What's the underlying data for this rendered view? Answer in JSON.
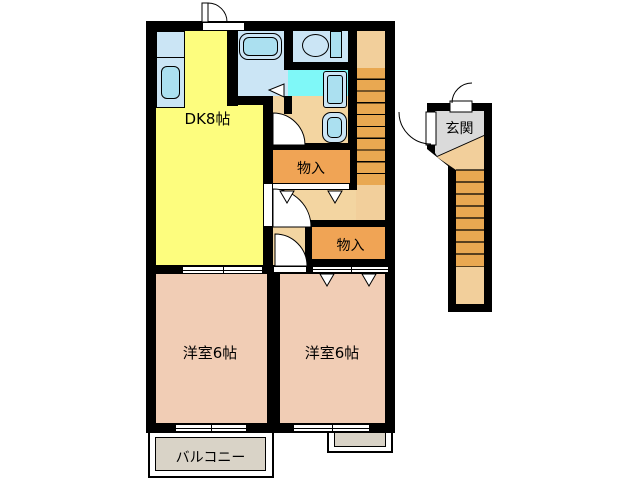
{
  "figure": {
    "type": "floor-plan",
    "description": "Japanese apartment floor plan, 2DK second-floor unit with external entrance stairs"
  },
  "rooms": {
    "dk": {
      "label": "DK8帖"
    },
    "bedroom_left": {
      "label": "洋室6帖"
    },
    "bedroom_right": {
      "label": "洋室6帖"
    },
    "storage_upper": {
      "label": "物入"
    },
    "storage_lower": {
      "label": "物入"
    },
    "balcony": {
      "label": "バルコニー"
    },
    "entrance": {
      "label": "玄関"
    }
  },
  "fixtures": {
    "kitchen_sink": "kitchen-sink-icon",
    "bathtub": "bathtub-icon",
    "toilet": "toilet-icon",
    "washing_machine": "washing-machine-icon",
    "washbasin": "washbasin-icon",
    "internal_stairs": "stairs-icon",
    "approach_stairs": "stairs-icon"
  },
  "colors": {
    "wall": "#000000",
    "dk": "#FDFD7E",
    "hall": "#F3D5A1",
    "bedroom": "#F1CDB5",
    "storage": "#F0A455",
    "stair_step": "#E9A851",
    "stair_landing": "#F2CF9B",
    "washroom": "#7FF8F8",
    "sanitary_room": "#CBE5F5",
    "fixture_fill": "#ABE0F0",
    "balcony": "#D9D3C7",
    "entrance_hall": "#DADADA"
  }
}
